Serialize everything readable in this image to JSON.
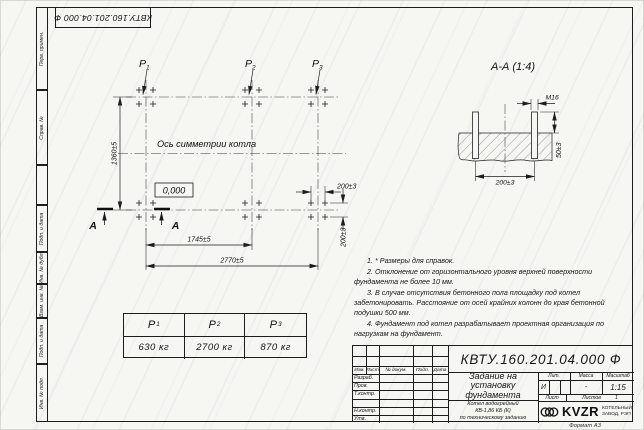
{
  "sheet": {
    "doc_number": "КВТУ.160.201.04.000 Ф",
    "format_label": "Формат А3"
  },
  "side_stamps": {
    "perv_primen": "Перв. примен.",
    "sprav_no": "Справ. №",
    "podp_data_1": "Подп. и дата",
    "inv_dubl": "Инв. № дубл.",
    "vzam_inv": "Взам. инв. №",
    "podp_data_2": "Подп. и дата",
    "inv_podl": "Инв. № подл."
  },
  "plan": {
    "axis_label": "Ось симметрии котла",
    "elevation_mark": "0,000",
    "section_letter_1": "А",
    "section_letter_2": "А",
    "leaders": [
      {
        "main": "P",
        "sub": "1"
      },
      {
        "main": "P",
        "sub": "2"
      },
      {
        "main": "P",
        "sub": "3"
      }
    ],
    "dims": {
      "height": "1360±5",
      "span_mid": "1745±5",
      "span_full": "2770±5",
      "bolt_x": "200±3",
      "bolt_y": "200±3"
    }
  },
  "section": {
    "title": "А-А (1:4)",
    "thread_label": "M16",
    "bolt_spacing": "200±3",
    "protrusion": "50±3"
  },
  "notes": {
    "items": [
      "1. * Размеры для справок.",
      "2. Отклонение от горизонтального уровня верхней поверхности фундамента не более 10 мм.",
      "3. В случае отсутствия бетонного пола площадку под котел забетонировать. Расстояние от осей крайних колонн до края бетонной подушки 500 мм.",
      "4. Фундамент под котел разрабатывает проектная организация по нагрузкам на фундамент."
    ]
  },
  "load_table": {
    "headers": [
      {
        "main": "P",
        "sub": "1"
      },
      {
        "main": "P",
        "sub": "2"
      },
      {
        "main": "P",
        "sub": "3"
      }
    ],
    "values": [
      "630 кг",
      "2700 кг",
      "870 кг"
    ]
  },
  "title_block": {
    "doc_number": "КВТУ.160.201.04.000 Ф",
    "title_lines": [
      "Задание на",
      "установку",
      "фундамента"
    ],
    "object_lines": [
      "Котел водогрейный",
      "КВ-1,86 КБ (К)",
      "по техническому заданию"
    ],
    "rev_headers": [
      "Изм.",
      "Лист",
      "№ докум.",
      "Подп.",
      "Дата"
    ],
    "roles": [
      "Разраб.",
      "Пров.",
      "Т.контр.",
      "",
      "Н.контр.",
      "Утв."
    ],
    "lit_header": "Лит.",
    "mass_header": "Масса",
    "scale_header": "Масштаб",
    "lit_value": "И",
    "mass_value": "-",
    "scale_value": "1:15",
    "sheet_label": "Лист",
    "sheets_label": "Листов",
    "sheets_value": "1",
    "logo_text": "KVZR",
    "logo_caption_1": "КОТЕЛЬНЫЙ",
    "logo_caption_2": "ЗАВОД, РЭП"
  }
}
